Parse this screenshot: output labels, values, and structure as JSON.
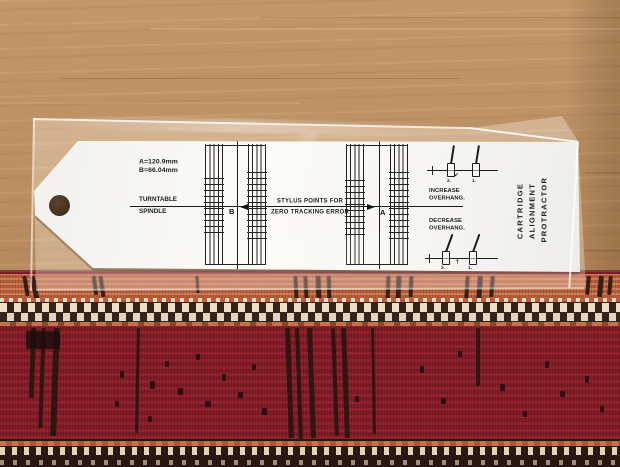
{
  "scene": {
    "description": "Turntable cartridge alignment protractor sealed in a clear plastic sleeve, lying on a wooden shelf above a red patterned rug"
  },
  "protractor": {
    "dimension_a": "A=120.9mm",
    "dimension_b": "B=66.04mm",
    "turntable_label_line1": "TURNTABLE",
    "turntable_label_line2": "SPINDLE",
    "stylus_note_line1": "STYLUS POINTS FOR",
    "stylus_note_line2": "ZERO TRACKING ERROR",
    "point_b_label": "B",
    "point_a_label": "A",
    "increase_line1": "INCREASE",
    "increase_line2": "OVERHANG.",
    "decrease_line1": "DECREASE",
    "decrease_line2": "OVERHANG.",
    "cartridge_label_2": "2.",
    "cartridge_label_1": "1.",
    "title_line1": "CARTRIDGE",
    "title_line2": "ALIGNMENT",
    "title_line3": "PROTRACTOR"
  },
  "colors": {
    "card_white": "#f8f7f4",
    "print_black": "#1c1c1c",
    "wood_tan": "#ba8d60",
    "rug_orange": "#c0663f",
    "rug_red": "#8c1f2b",
    "rug_cream": "#e8dcc0",
    "rug_dark": "#32201a"
  }
}
